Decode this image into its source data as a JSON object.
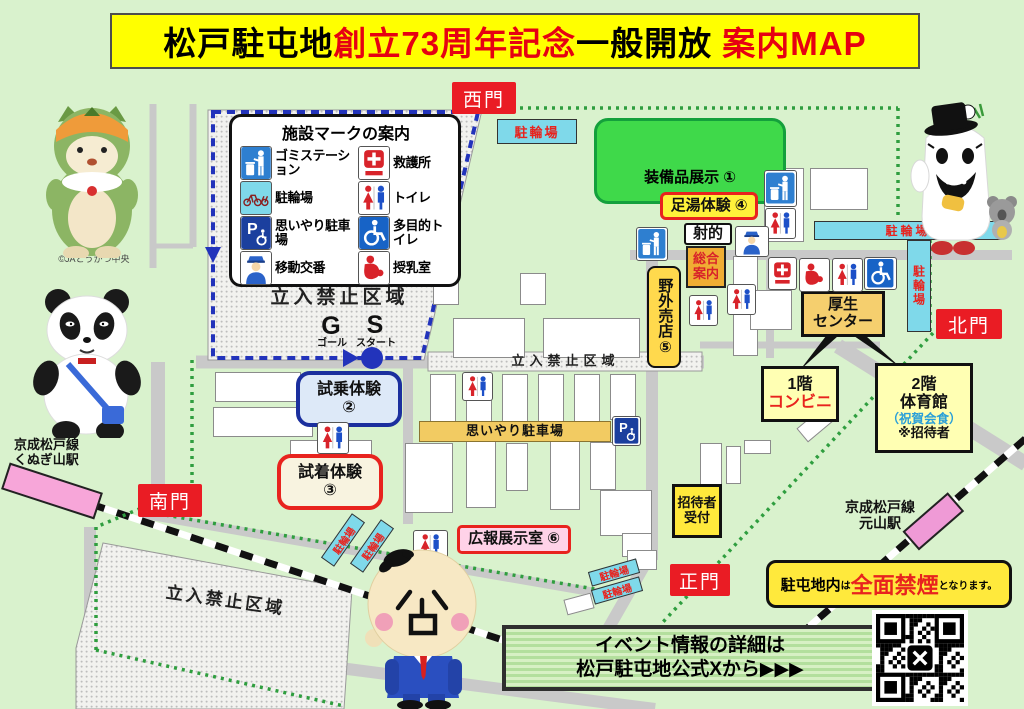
{
  "title": {
    "black1": "松戸駐屯地",
    "red1": "創立73周年記念",
    "black2": "一般開放",
    "red2": "案内MAP"
  },
  "gates": {
    "west": "西門",
    "north": "北門",
    "south": "南門",
    "main": "正門"
  },
  "legend": {
    "title": "施設マークの案内",
    "items": [
      {
        "icon": "trash-station-icon",
        "label": "ゴミステーション"
      },
      {
        "icon": "first-aid-icon",
        "label": "救護所"
      },
      {
        "icon": "bicycle-parking-icon",
        "label": "駐輪場"
      },
      {
        "icon": "toilet-icon",
        "label": "トイレ"
      },
      {
        "icon": "priority-parking-icon",
        "label": "思いやり駐車場"
      },
      {
        "icon": "accessible-toilet-icon",
        "label": "多目的トイレ"
      },
      {
        "icon": "mobile-police-icon",
        "label": "移動交番"
      },
      {
        "icon": "nursing-room-icon",
        "label": "授乳室"
      }
    ]
  },
  "venues": {
    "equipment_display": "装備品展示 ①",
    "footbath": "足湯体験 ④",
    "shooting_range": "射的",
    "info_l1": "総合",
    "info_l2": "案内",
    "outdoor_shop": "野外売店⑤",
    "welfare_l1": "厚生",
    "welfare_l2": "センター",
    "floor1_l1": "1階",
    "floor1_l2": "コンビニ",
    "floor2_l1": "2階",
    "floor2_l2": "体育館",
    "floor2_l3": "（祝賀会食）",
    "floor2_l4": "※招待者",
    "test_ride_l1": "試乗体験",
    "test_ride_l2": "②",
    "try_on_l1": "試着体験",
    "try_on_l2": "③",
    "pr_room": "広報展示室 ⑥",
    "reception_l1": "招待者",
    "reception_l2": "受付",
    "priority_parking": "思いやり駐車場",
    "bicycle_parking": "駐輪場",
    "restricted_area": "立入禁止区域"
  },
  "course": {
    "goal_letter": "G",
    "start_letter": "S",
    "goal": "ゴール",
    "start": "スタート"
  },
  "stations": {
    "line_name": "京成松戸線",
    "kunugi": "くぬぎ山駅",
    "motoyama": "元山駅"
  },
  "notes": {
    "no_smoking_pre": "駐屯地内",
    "no_smoking_wa": "は",
    "no_smoking_main": "全面禁煙",
    "no_smoking_post": "となります。",
    "event_l1": "イベント情報の詳細は",
    "event_l2": "松戸駐屯地公式Xから▶▶▶",
    "ja_credit": "©JAとうかつ中央"
  },
  "colors": {
    "accent_red": "#e8231e",
    "gate_red": "#ea1c24",
    "cyan": "#7fd9ea",
    "yellow": "#ffe93c",
    "equipment_green": "#3fd94a",
    "route_blue": "#2233bb"
  }
}
